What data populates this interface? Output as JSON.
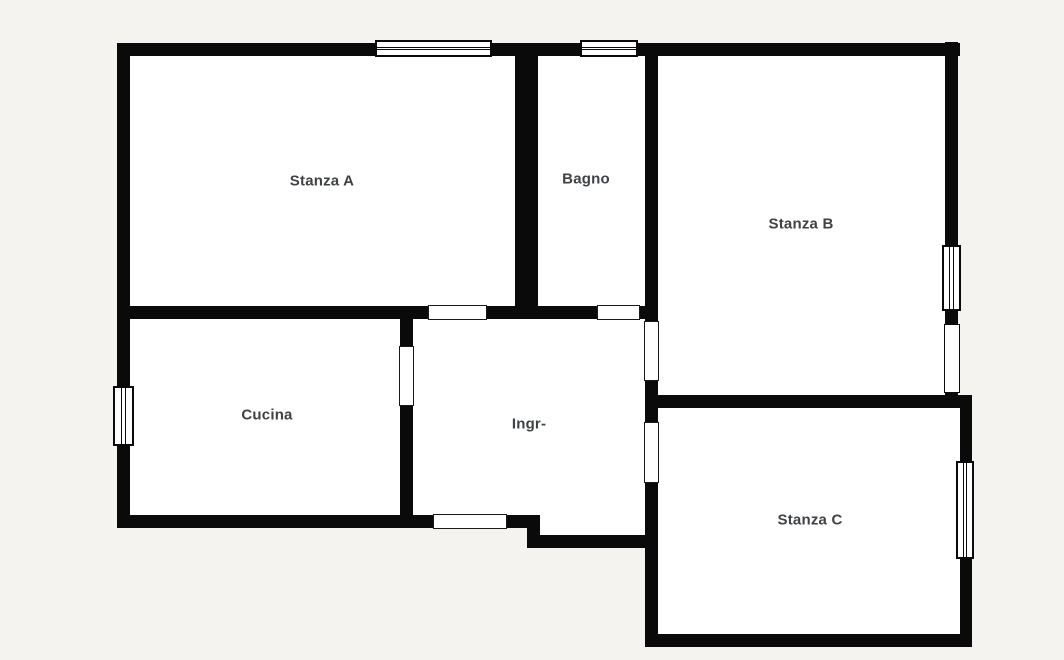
{
  "title": "Apartment floor plan",
  "colors": {
    "background": "#f5f3f0",
    "wall": "#0a0a0a",
    "room_fill": "#ffffff",
    "label": "#3f4245"
  },
  "rooms": [
    {
      "id": "stanza-a",
      "label": "Stanza A",
      "label_x": 322,
      "label_y": 181
    },
    {
      "id": "bagno",
      "label": "Bagno",
      "label_x": 586,
      "label_y": 179
    },
    {
      "id": "stanza-b",
      "label": "Stanza B",
      "label_x": 801,
      "label_y": 224
    },
    {
      "id": "cucina",
      "label": "Cucina",
      "label_x": 267,
      "label_y": 415
    },
    {
      "id": "ingresso",
      "label": "Ingr-",
      "label_x": 529,
      "label_y": 424
    },
    {
      "id": "stanza-c",
      "label": "Stanza C",
      "label_x": 810,
      "label_y": 520
    }
  ],
  "geometry": {
    "room_fills": [
      {
        "name": "room-fill-stanza-a",
        "x": 123,
        "y": 49,
        "w": 398,
        "h": 264
      },
      {
        "name": "room-fill-bagno",
        "x": 530,
        "y": 49,
        "w": 122,
        "h": 264
      },
      {
        "name": "room-fill-stanza-b",
        "x": 650,
        "y": 48,
        "w": 302,
        "h": 352
      },
      {
        "name": "room-fill-cucina",
        "x": 123,
        "y": 312,
        "w": 285,
        "h": 210
      },
      {
        "name": "room-fill-ingresso",
        "x": 406,
        "y": 312,
        "w": 246,
        "h": 210
      },
      {
        "name": "room-fill-ingresso-notch",
        "x": 533,
        "y": 515,
        "w": 119,
        "h": 26
      },
      {
        "name": "room-fill-stanza-c",
        "x": 650,
        "y": 400,
        "w": 316,
        "h": 240
      }
    ],
    "walls": [
      {
        "name": "wall-top",
        "x": 117,
        "y": 43,
        "w": 843,
        "h": 13
      },
      {
        "name": "wall-stanza-a-bottom",
        "x": 117,
        "y": 306,
        "w": 541,
        "h": 13
      },
      {
        "name": "wall-stanza-b-bottom",
        "x": 645,
        "y": 395,
        "w": 327,
        "h": 13
      },
      {
        "name": "wall-cucina-bottom",
        "x": 117,
        "y": 515,
        "w": 423,
        "h": 13
      },
      {
        "name": "wall-ingresso-notch-bottom",
        "x": 527,
        "y": 535,
        "w": 131,
        "h": 13
      },
      {
        "name": "wall-stanza-c-bottom",
        "x": 645,
        "y": 634,
        "w": 327,
        "h": 13
      },
      {
        "name": "wall-left",
        "x": 117,
        "y": 43,
        "w": 13,
        "h": 485
      },
      {
        "name": "wall-bagno-left",
        "x": 515,
        "y": 43,
        "w": 23,
        "h": 276
      },
      {
        "name": "wall-bagno-right",
        "x": 645,
        "y": 43,
        "w": 13,
        "h": 365
      },
      {
        "name": "wall-stanza-c-left",
        "x": 645,
        "y": 395,
        "w": 13,
        "h": 252
      },
      {
        "name": "wall-cucina-ingresso",
        "x": 400,
        "y": 306,
        "w": 13,
        "h": 222
      },
      {
        "name": "wall-ingresso-notch-left",
        "x": 527,
        "y": 515,
        "w": 13,
        "h": 33
      },
      {
        "name": "wall-stanza-b-right",
        "x": 945,
        "y": 42,
        "w": 13,
        "h": 366
      },
      {
        "name": "wall-stanza-c-right",
        "x": 960,
        "y": 395,
        "w": 12,
        "h": 252
      }
    ],
    "doors": [
      {
        "name": "door-stanza-a-ingresso",
        "x": 428,
        "y": 305,
        "w": 59,
        "h": 15
      },
      {
        "name": "door-bagno-ingresso",
        "x": 597,
        "y": 305,
        "w": 43,
        "h": 15
      },
      {
        "name": "door-stanza-b-ingresso",
        "x": 644,
        "y": 321,
        "w": 15,
        "h": 60
      },
      {
        "name": "door-cucina-ingresso",
        "x": 399,
        "y": 346,
        "w": 15,
        "h": 60
      },
      {
        "name": "door-stanza-c-ingresso",
        "x": 644,
        "y": 422,
        "w": 15,
        "h": 61
      },
      {
        "name": "door-ingresso-exit",
        "x": 433,
        "y": 514,
        "w": 74,
        "h": 15
      }
    ],
    "windows": [
      {
        "name": "window-stanza-a-top",
        "x": 375,
        "y": 40,
        "w": 117,
        "h": 17,
        "orient": "h",
        "style": "double"
      },
      {
        "name": "window-bagno-top",
        "x": 580,
        "y": 40,
        "w": 58,
        "h": 17,
        "orient": "h",
        "style": "double"
      },
      {
        "name": "window-stanza-b-right-1",
        "x": 942,
        "y": 245,
        "w": 19,
        "h": 66,
        "orient": "v",
        "style": "double"
      },
      {
        "name": "window-stanza-b-right-2",
        "x": 944,
        "y": 324,
        "w": 16,
        "h": 69,
        "orient": "v",
        "style": "plain"
      },
      {
        "name": "window-stanza-c-right",
        "x": 956,
        "y": 461,
        "w": 18,
        "h": 98,
        "orient": "v",
        "style": "double"
      },
      {
        "name": "window-cucina-left",
        "x": 113,
        "y": 386,
        "w": 21,
        "h": 60,
        "orient": "v",
        "style": "double"
      }
    ]
  }
}
